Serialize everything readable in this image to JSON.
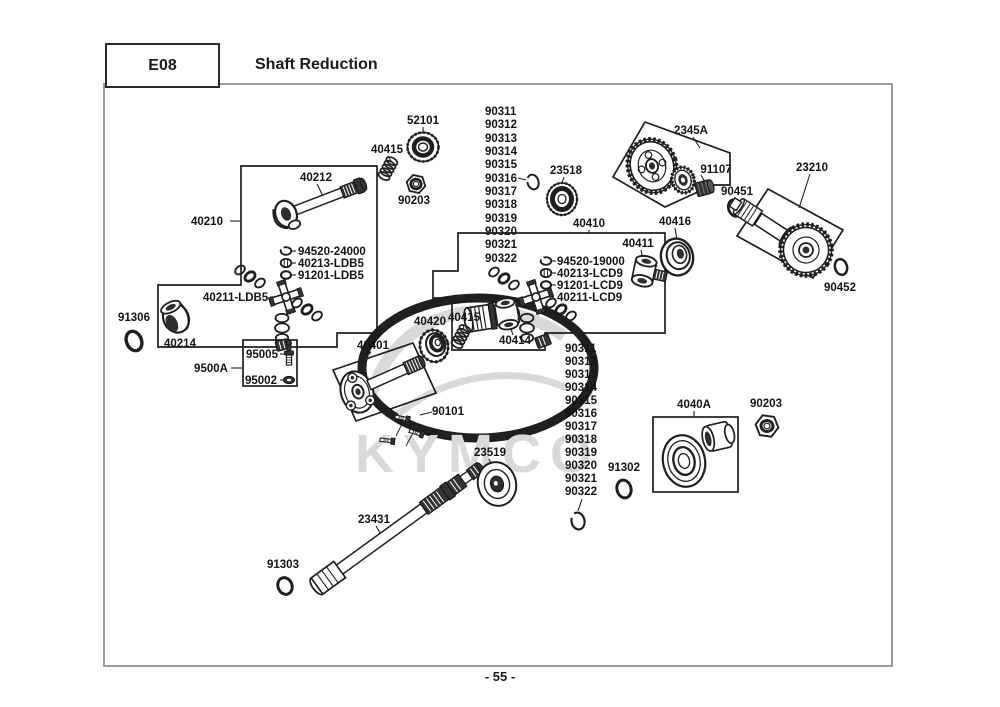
{
  "header": {
    "code": "E08",
    "title": "Shaft Reduction"
  },
  "footer": {
    "page_number": "- 55 -"
  },
  "watermark": {
    "text": "KYMCO"
  },
  "colors": {
    "line": "#1f1f1f",
    "border_gray": "#9b9b9b",
    "watermark": "#d9d9d9"
  },
  "labels": {
    "l52101": "52101",
    "l40415a": "40415",
    "l90203a": "90203",
    "l40212": "40212",
    "l40210": "40210",
    "l94520_24000": "94520-24000",
    "l40213_ldb5": "40213-LDB5",
    "l91201_ldb5": "91201-LDB5",
    "l40211_ldb5": "40211-LDB5",
    "l91306": "91306",
    "l40214": "40214",
    "l9500a": "9500A",
    "l95005": "95005",
    "l95002": "95002",
    "l23518": "23518",
    "l2345a": "2345A",
    "l91107": "91107",
    "l90451": "90451",
    "l23210": "23210",
    "l90452": "90452",
    "l40410": "40410",
    "l40416": "40416",
    "l40411": "40411",
    "l94520_19000": "94520-19000",
    "l40213_lcd9": "40213-LCD9",
    "l91201_lcd9": "91201-LCD9",
    "l40211_lcd9": "40211-LCD9",
    "l40414": "40414",
    "l40420": "40420",
    "l40415b": "40415",
    "l40401": "40401",
    "l90101": "90101",
    "l91302": "91302",
    "l4040a": "4040A",
    "l90203b": "90203",
    "l23519": "23519",
    "l23431": "23431",
    "l91303": "91303"
  },
  "columns": {
    "left": [
      "90311",
      "90312",
      "90313",
      "90314",
      "90315",
      "90316",
      "90317",
      "90318",
      "90319",
      "90320",
      "90321",
      "90322"
    ],
    "right": [
      "90311",
      "90312",
      "90313",
      "90314",
      "90315",
      "90316",
      "90317",
      "90318",
      "90319",
      "90320",
      "90321",
      "90322"
    ]
  }
}
